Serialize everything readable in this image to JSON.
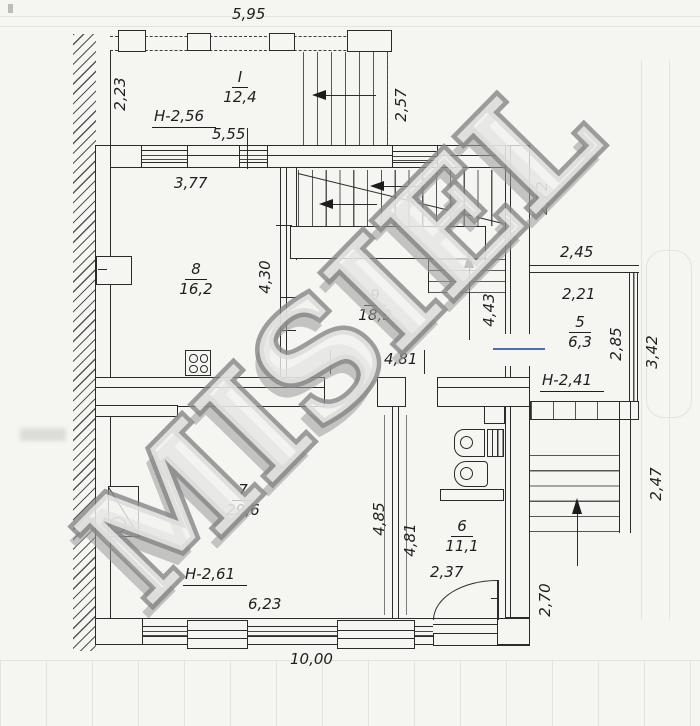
{
  "watermark": "MISIEL",
  "rooms": {
    "terrace": {
      "num": "I",
      "area": "12,4",
      "h": "H-2,56"
    },
    "r8": {
      "num": "8",
      "area": "16,2"
    },
    "r9": {
      "num": "9",
      "area": "18,9"
    },
    "r5": {
      "num": "5",
      "area": "6,3",
      "h": "H-2,41"
    },
    "r6": {
      "num": "6",
      "area": "11,1"
    },
    "r7": {
      "num": "7",
      "area": "29,6",
      "h": "H-2,61"
    }
  },
  "dims": {
    "terrace_width": "5,95",
    "terrace_left": "2,23",
    "terrace_right": "2,57",
    "top_wall": "5,55",
    "room8_width": "3,77",
    "upper_right": "2,72",
    "room8_east": "4,30",
    "stair_east": "4,43",
    "balcony_top": "2,45",
    "balcony_inner_top": "2,21",
    "balcony_inner_right": "2,85",
    "balcony_outer_right": "3,42",
    "corridor": "4,81",
    "room7_side": "4,85",
    "room6_side": "4,81",
    "ext_stair_right": "2,47",
    "bath_width": "2,37",
    "lower_right": "2,70",
    "room7_width": "6,23",
    "building_width": "10,00"
  }
}
